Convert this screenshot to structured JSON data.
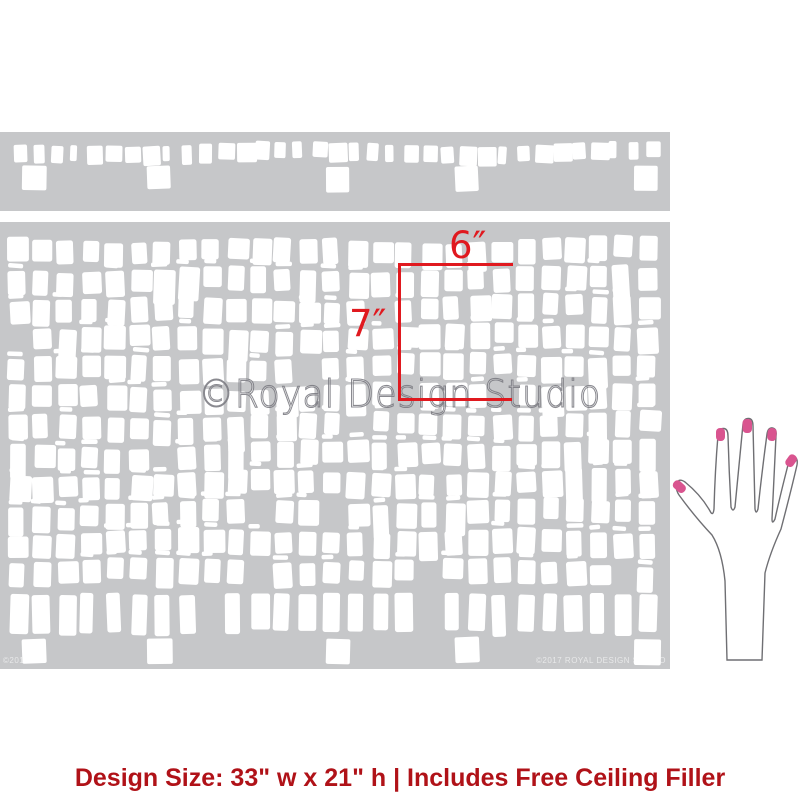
{
  "colors": {
    "stencil_gray": "#c6c7c9",
    "pattern_white": "#ffffff",
    "dimension_red": "#e0191f",
    "caption_red": "#b01218",
    "nail_pink": "#d9548f",
    "hand_outline": "#6f6f73"
  },
  "stencil": {
    "watermark": "©Royal Design Studio",
    "corner_left_text": "©2011",
    "corner_right_text": "©2017 ROYAL DESIGN STUDIO",
    "filler_square_xs": [
      22,
      147,
      326,
      455,
      634
    ]
  },
  "dimensions": {
    "width_label": "6″",
    "height_label": "7″"
  },
  "caption": {
    "text": "Design Size: 33\" w x 21\" h | Includes Free Ceiling Filler"
  },
  "hand": {
    "icon": "hand-with-painted-nails-illustration"
  }
}
